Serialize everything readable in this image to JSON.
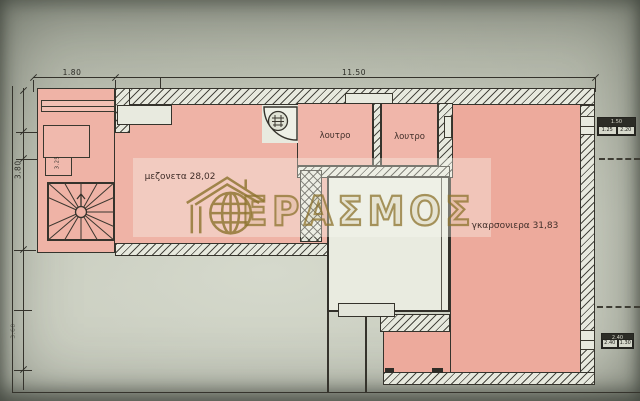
{
  "meta": {
    "document_type": "architectural floor plan (scanned blueprint photo)",
    "language": "Greek"
  },
  "dimensions": {
    "top1": "1.80",
    "top2": "11.50",
    "left1": "3.80",
    "left2": "3.60",
    "inner": "3.25"
  },
  "rooms": {
    "maisonette": {
      "label": "μεζονετα 28,02",
      "area_sqm": "28,02"
    },
    "bath1": {
      "label": "λουτρο"
    },
    "bath2": {
      "label": "λουτρο"
    },
    "studio": {
      "label": "γκαρσονιερα 31,83",
      "area_sqm": "31,83"
    }
  },
  "watermark": {
    "text": "ΕΡΑΣΜΟΣ",
    "logo": "house-globe-icon"
  },
  "tags": {
    "top": {
      "header": "1.50",
      "c1": "1.25",
      "c2": "2.20"
    },
    "bottom": {
      "header": "2.40",
      "c1": "2.40",
      "c2": "1.30"
    }
  },
  "colors": {
    "room_fill_pink": "#efb3a6",
    "paper": "#c6cabb",
    "ink": "#35332c",
    "watermark": "#8c732d",
    "courtyard": "#e8eadf"
  },
  "features": {
    "staircase": "winder staircase with radiating treads",
    "door_arc": "quarter-circle door swing with circular symbol",
    "walls": "diagonal-hatched masonry walls",
    "courtyard": "unshaded light well between units"
  }
}
